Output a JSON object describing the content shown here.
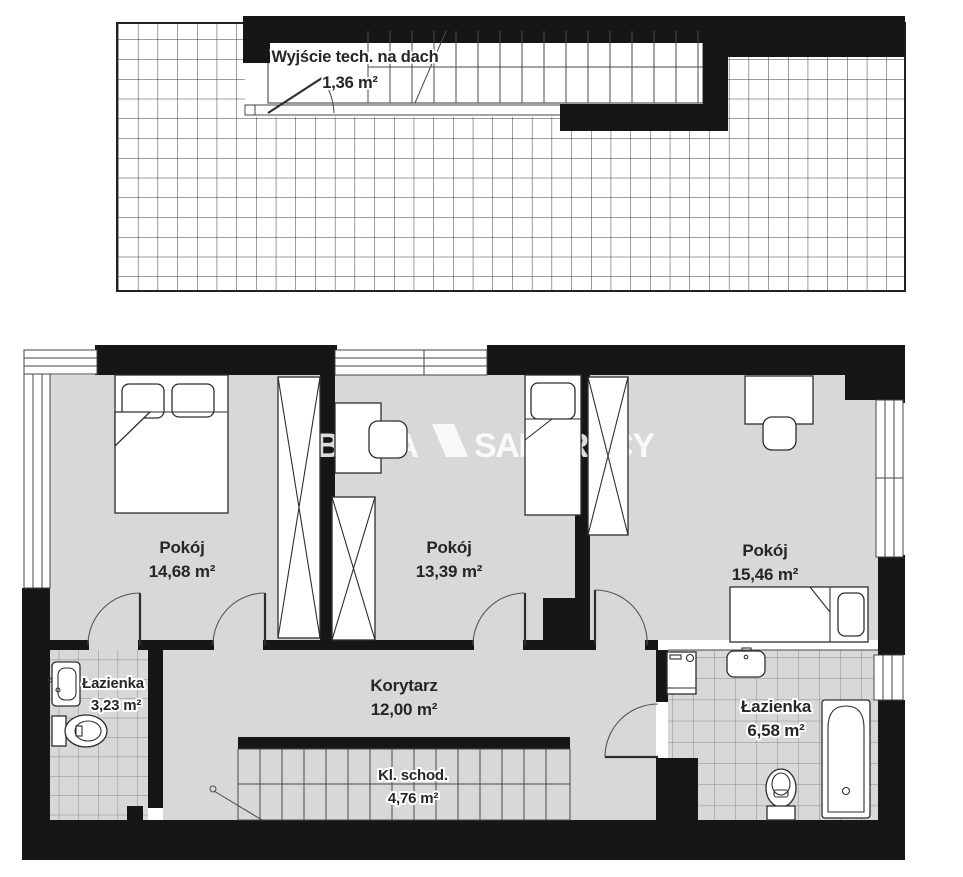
{
  "watermark": {
    "part1": "BRACIA",
    "part2": "SADURSCY",
    "logo_icon": "slanted-parallelogram"
  },
  "roof": {
    "label": "Wyjście tech. na dach",
    "area": "1,36 m²"
  },
  "rooms": {
    "room_left": {
      "label": "Pokój",
      "area": "14,68 m²"
    },
    "room_mid": {
      "label": "Pokój",
      "area": "13,39 m²"
    },
    "room_right": {
      "label": "Pokój",
      "area": "15,46 m²"
    },
    "bath_left": {
      "label": "Łazienka",
      "area": "3,23 m²"
    },
    "corridor": {
      "label": "Korytarz",
      "area": "12,00 m²"
    },
    "stairs": {
      "label": "Kl. schod.",
      "area": "4,76 m²"
    },
    "bath_right": {
      "label": "Łazienka",
      "area": "6,58 m²"
    }
  },
  "colors": {
    "wall": "#161616",
    "floor": "#d8d8d8",
    "tile-line": "#8c8c8c",
    "roof-line": "#3c3c3c",
    "wm": "#ffffff",
    "text": "#262626"
  }
}
